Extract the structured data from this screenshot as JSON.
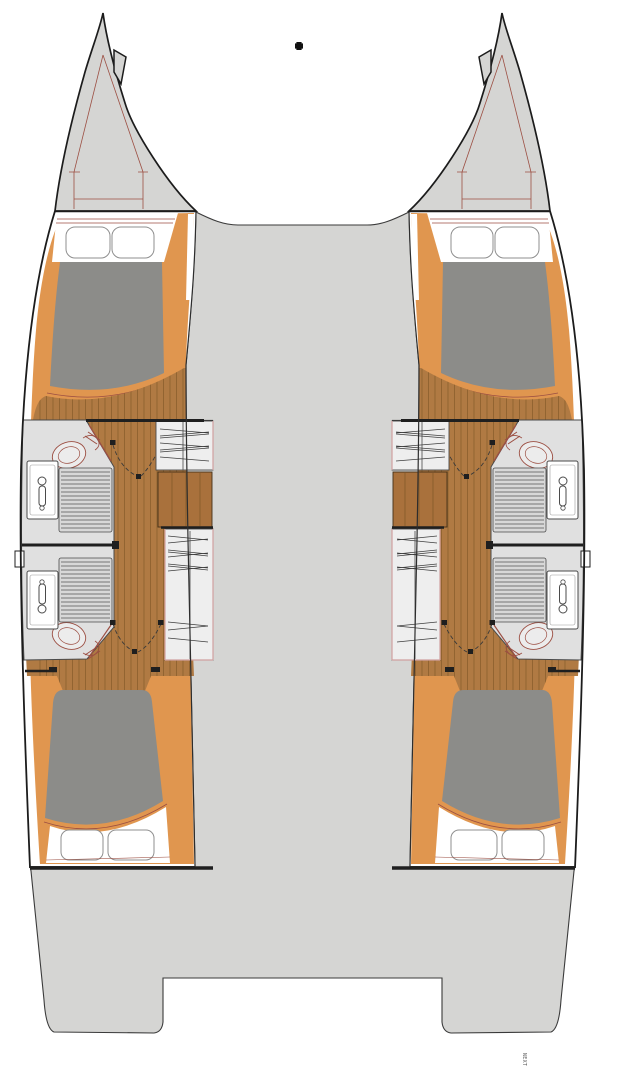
{
  "watermark": {
    "text": "NEXT"
  },
  "palette": {
    "background": "#ffffff",
    "deck_gray": "#d5d5d3",
    "hull_outline": "#1c1c1c",
    "mid_line": "#3a3a3a",
    "trim_orange": "#e0964f",
    "sole_wood": "#b07а43",
    "sole_wood_fix": "#b07a43",
    "sole_plank_line": "#7d5626",
    "step_wood": "#a9713c",
    "mattress_gray": "#8c8c89",
    "head_floor": "#e0e0e0",
    "grate_floor": "#d8d8d8",
    "fixture_white": "#ffffff",
    "fixture_outline": "#4a4a4a",
    "detail_red": "#9c4f43",
    "furniture_pink": "#d0a0a0",
    "wardrobe_fill": "#eeeeee",
    "hanger_line": "#3f3f3f",
    "dark_line": "#1f1f1f",
    "pillow_outline": "#8f8f8f"
  },
  "diagram": {
    "type": "catamaran-lower-deck-floor-plan",
    "center_areas": [
      "foredeck-bridge",
      "bridgedeck",
      "aft-platform",
      "transom-steps"
    ],
    "hulls": [
      {
        "side": "port",
        "rooms": [
          "forward-cabin",
          "forward-head",
          "aft-head",
          "aft-cabin"
        ],
        "fixtures": [
          "anchor-locker",
          "double-berth-forward",
          "pillows",
          "toilet-forward",
          "sink-forward",
          "shower-grate-forward",
          "toilet-aft",
          "sink-aft",
          "shower-grate-aft",
          "hanging-locker-forward",
          "companionway-steps",
          "hanging-locker-aft",
          "double-berth-aft",
          "porthole"
        ]
      },
      {
        "side": "starboard",
        "rooms": [
          "forward-cabin",
          "forward-head",
          "aft-head",
          "aft-cabin"
        ],
        "fixtures": [
          "anchor-locker",
          "double-berth-forward",
          "pillows",
          "toilet-forward",
          "sink-forward",
          "shower-grate-forward",
          "toilet-aft",
          "sink-aft",
          "shower-grate-aft",
          "hanging-locker-forward",
          "companionway-steps",
          "hanging-locker-aft",
          "double-berth-aft",
          "porthole"
        ]
      }
    ]
  }
}
